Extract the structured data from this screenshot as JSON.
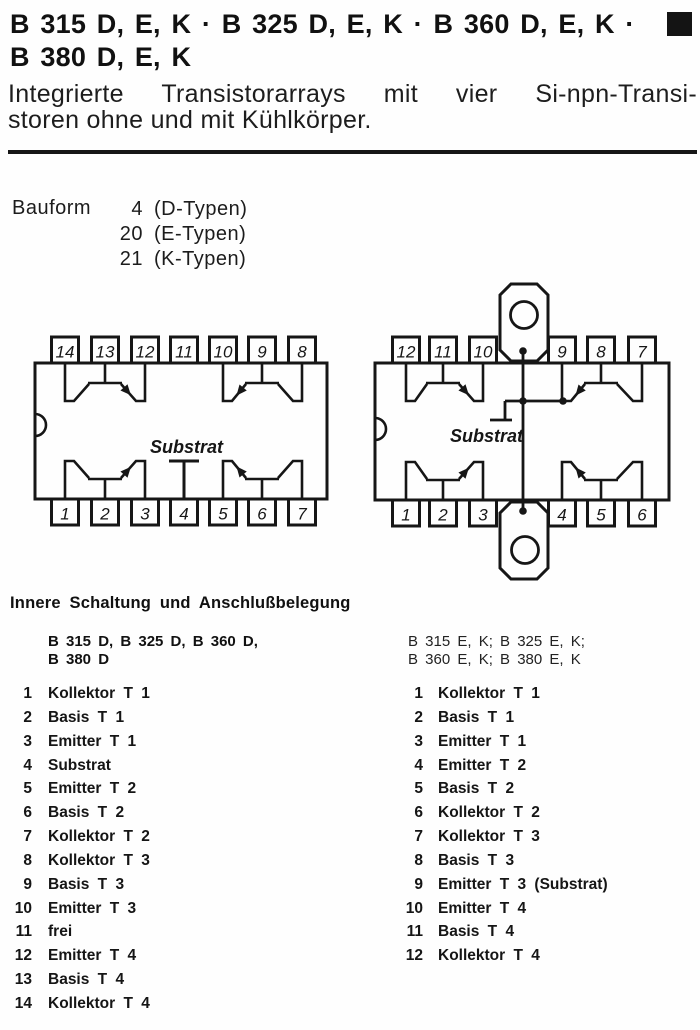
{
  "page": {
    "title_line1": "B 315 D, E, K · B 325 D, E, K · B 360 D, E, K ·",
    "title_line2": "B 380 D, E, K",
    "subtitle_line1": "Integrierte Transistorarrays mit vier Si-npn-Transi-",
    "subtitle_line2": "storen ohne und mit Kühlkörper."
  },
  "bauform": {
    "label": "Bauform",
    "rows": [
      {
        "number": "4",
        "type": "(D-Typen)"
      },
      {
        "number": "20",
        "type": "(E-Typen)"
      },
      {
        "number": "21",
        "type": "(K-Typen)"
      }
    ]
  },
  "diagrams": {
    "left_package": {
      "top_pins": [
        "14",
        "13",
        "12",
        "11",
        "10",
        "9",
        "8"
      ],
      "bottom_pins": [
        "1",
        "2",
        "3",
        "4",
        "5",
        "6",
        "7"
      ],
      "substrat_label": "Substrat"
    },
    "right_package": {
      "top_pins": [
        "12",
        "11",
        "10",
        "9",
        "8",
        "7"
      ],
      "bottom_pins": [
        "1",
        "2",
        "3",
        "4",
        "5",
        "6"
      ],
      "substrat_label": "Substrat"
    }
  },
  "pinout": {
    "heading": "Innere Schaltung und Anschlußbelegung",
    "left_column": {
      "subheading_line1": "B 315 D, B 325 D, B 360 D,",
      "subheading_line2": "B 380 D",
      "pins": [
        {
          "number": "1",
          "label": "Kollektor T 1"
        },
        {
          "number": "2",
          "label": "Basis T 1"
        },
        {
          "number": "3",
          "label": "Emitter T 1"
        },
        {
          "number": "4",
          "label": "Substrat"
        },
        {
          "number": "5",
          "label": "Emitter T 2"
        },
        {
          "number": "6",
          "label": "Basis T 2"
        },
        {
          "number": "7",
          "label": "Kollektor T 2"
        },
        {
          "number": "8",
          "label": "Kollektor T 3"
        },
        {
          "number": "9",
          "label": "Basis T 3"
        },
        {
          "number": "10",
          "label": "Emitter T 3"
        },
        {
          "number": "11",
          "label": "frei"
        },
        {
          "number": "12",
          "label": "Emitter T 4"
        },
        {
          "number": "13",
          "label": "Basis T 4"
        },
        {
          "number": "14",
          "label": "Kollektor T 4"
        }
      ]
    },
    "right_column": {
      "subheading_line1": "B 315 E, K; B 325 E, K;",
      "subheading_line2": "B 360 E, K; B 380 E, K",
      "pins": [
        {
          "number": "1",
          "label": "Kollektor T 1"
        },
        {
          "number": "2",
          "label": "Basis T 1"
        },
        {
          "number": "3",
          "label": "Emitter T 1"
        },
        {
          "number": "4",
          "label": "Emitter T 2"
        },
        {
          "number": "5",
          "label": "Basis T 2"
        },
        {
          "number": "6",
          "label": "Kollektor T 2"
        },
        {
          "number": "7",
          "label": "Kollektor T 3"
        },
        {
          "number": "8",
          "label": "Basis T 3"
        },
        {
          "number": "9",
          "label": "Emitter T 3 (Substrat)"
        },
        {
          "number": "10",
          "label": "Emitter T 4"
        },
        {
          "number": "11",
          "label": "Basis T 4"
        },
        {
          "number": "12",
          "label": "Kollektor T 4"
        }
      ]
    }
  },
  "colors": {
    "ink": "#161616",
    "paper": "#fefefe"
  }
}
